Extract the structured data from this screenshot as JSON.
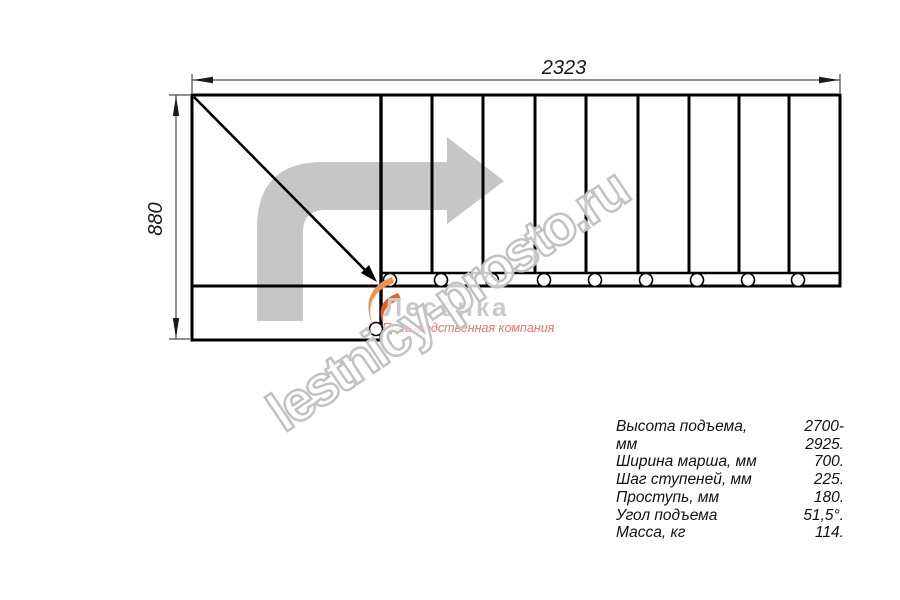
{
  "page": {
    "background": "#ffffff"
  },
  "dimensions": {
    "top_label": "2323",
    "left_label": "880"
  },
  "staircase": {
    "tread_dividers_x": [
      432,
      483,
      535,
      586,
      638,
      689,
      739,
      789
    ],
    "baluster_circles_x": [
      390,
      441,
      492,
      544,
      595,
      646,
      697,
      748,
      798
    ],
    "baluster_circles_y": 280,
    "flight_circle": {
      "x": 376,
      "y": 329
    },
    "line_color": "#000000",
    "dim_color": "#4a4a4a"
  },
  "direction_arrow": {
    "color": "#c6c6c6"
  },
  "watermark": {
    "text": "lestnicy-prosto.ru",
    "outline_color": "#c2c2c2"
  },
  "logo": {
    "name": "Лесенка",
    "tagline": "Производственная компания",
    "name_color": "#c9c9c9",
    "tagline_color": "#e4756e",
    "flame_main_color": "#f0914f",
    "flame_accent_color": "#e85b28"
  },
  "specs": {
    "rows": [
      {
        "label": "Высота подъема, мм",
        "value": "2700-2925."
      },
      {
        "label": "Ширина марша, мм",
        "value": "700."
      },
      {
        "label": "Шаг ступеней, мм",
        "value": "225."
      },
      {
        "label": "Проступь, мм",
        "value": "180."
      },
      {
        "label": "Угол подъема",
        "value": "51,5°."
      },
      {
        "label": "Масса, кг",
        "value": "114."
      }
    ]
  }
}
